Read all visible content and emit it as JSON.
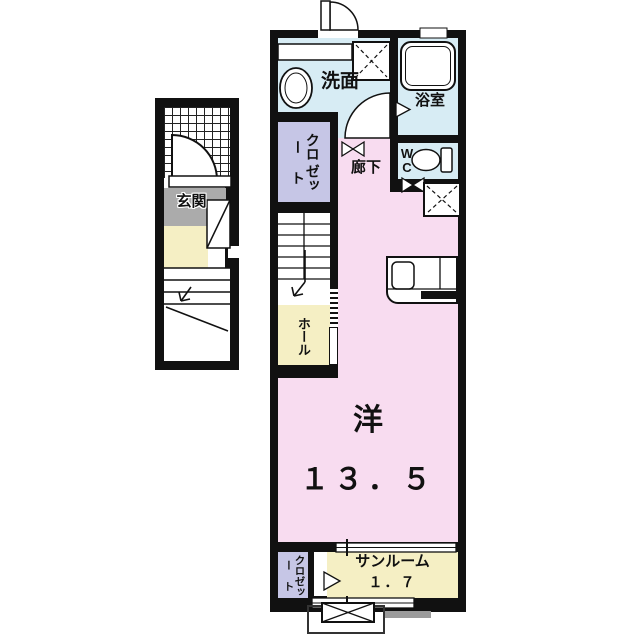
{
  "colors": {
    "wall": "#111111",
    "wet_room": "#d7ecf4",
    "closet": "#c6c6e6",
    "room_pink": "#f8dcf0",
    "hall_yellow": "#f5efc4",
    "entry_gray": "#ababab",
    "balcony_gray": "#9b9b9b"
  },
  "left_unit": {
    "entry_label": "玄関"
  },
  "main_unit": {
    "washroom_label": "洗面",
    "bath_label": "浴室",
    "corridor_label": "廊下",
    "wc_line1": "W",
    "wc_line2": "C",
    "closet_upper_col1": "クロー",
    "closet_upper_col2": "ゼット",
    "hall_label": "ホール",
    "room_label": "洋",
    "room_size": "１３．５",
    "sunroom_label": "サンルーム",
    "sunroom_size": "１．７",
    "closet_lower_col1": "クロー",
    "closet_lower_col2": "ゼット"
  }
}
